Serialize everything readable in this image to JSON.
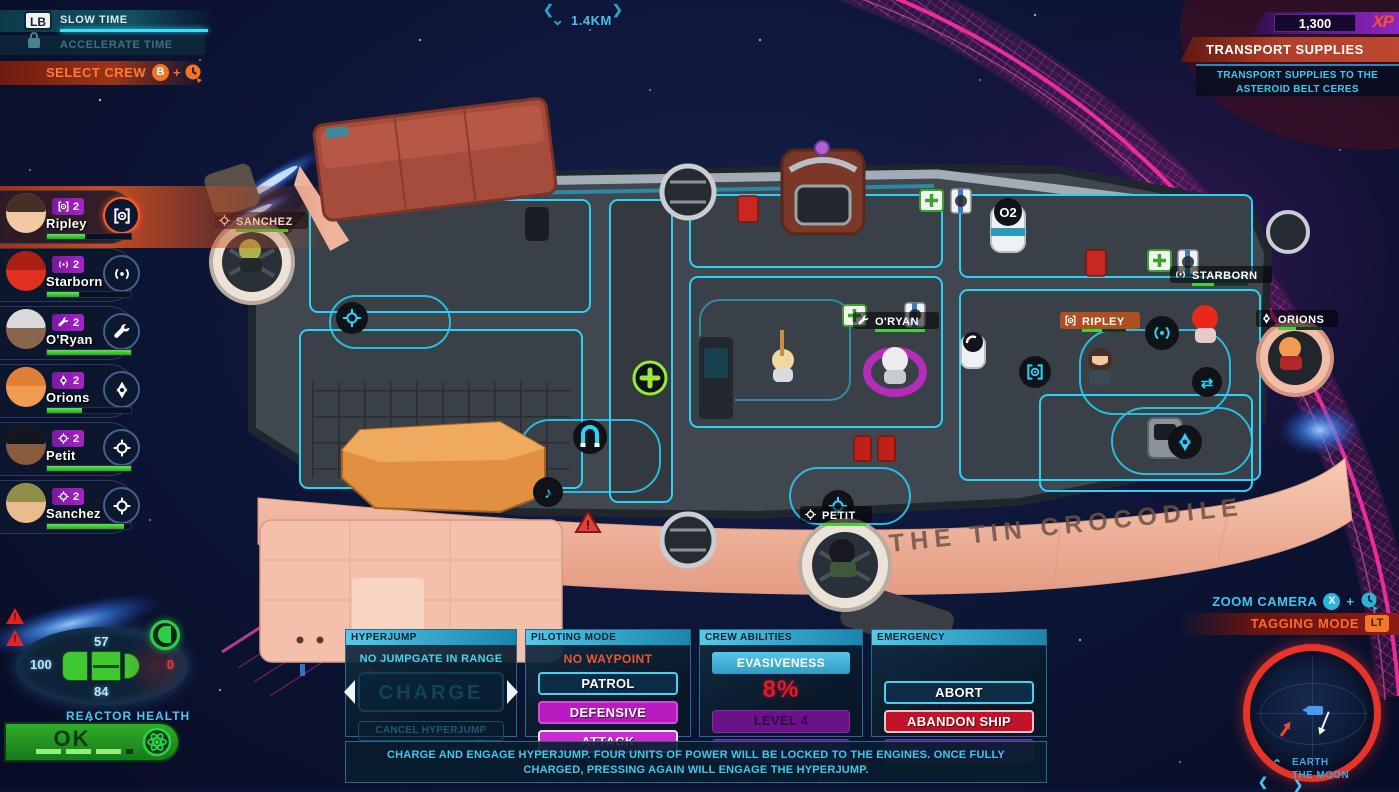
{
  "hud": {
    "top_left": {
      "slow_time_key": "LB",
      "slow_time_label": "SLOW TIME",
      "accelerate_time_label": "ACCELERATE TIME",
      "select_crew_label": "SELECT CREW",
      "select_crew_key": "B",
      "select_crew_plus": "+"
    },
    "top_center": {
      "distance_label": "1.4KM",
      "chevron_left": "❮",
      "chevron_right": "❯",
      "chevron_down": "⌄"
    },
    "top_right": {
      "xp_value": "1,300",
      "xp_label": "XP",
      "mission_title": "TRANSPORT SUPPLIES",
      "mission_objective_line1": "TRANSPORT SUPPLIES TO THE",
      "mission_objective_line2": "ASTEROID BELT CERES"
    },
    "right": {
      "zoom_camera_label": "ZOOM CAMERA",
      "zoom_camera_key": "X",
      "zoom_camera_plus": "+",
      "tagging_mode_label": "TAGGING MODE",
      "tagging_mode_key": "LT"
    },
    "minimap": {
      "location_line1": "EARTH",
      "location_line2": "THE MOON",
      "nav_up": "⌃",
      "nav_left": "❮",
      "nav_right": "❯"
    },
    "warning_mark": "!"
  },
  "crew_panel": {
    "members": [
      {
        "name": "Ripley",
        "level": "2",
        "role": "gunner",
        "health_pct": 45,
        "selected": true,
        "skin": "#f2c9a4",
        "hair": "#463024"
      },
      {
        "name": "Starborn",
        "level": "2",
        "role": "comms",
        "health_pct": 38,
        "selected": false,
        "skin": "#e23020",
        "hair": "#a82014"
      },
      {
        "name": "O'Ryan",
        "level": "2",
        "role": "engineer",
        "health_pct": 100,
        "selected": false,
        "skin": "#8a6550",
        "hair": "#d9d9d9"
      },
      {
        "name": "Orions",
        "level": "2",
        "role": "security",
        "health_pct": 42,
        "selected": false,
        "skin": "#f29a50",
        "hair": "#e08038"
      },
      {
        "name": "Petit",
        "level": "2",
        "role": "weapons",
        "health_pct": 100,
        "selected": false,
        "skin": "#8a5a3c",
        "hair": "#15151d"
      },
      {
        "name": "Sanchez",
        "level": "2",
        "role": "weapons",
        "health_pct": 92,
        "selected": false,
        "skin": "#ebbb90",
        "hair": "#8f8f4a"
      }
    ]
  },
  "ship_status": {
    "shield_top": "57",
    "shield_left": "100",
    "shield_right": "0",
    "shield_bottom": "84"
  },
  "reactor": {
    "label": "REACTOR HEALTH",
    "status": "OK"
  },
  "command_panels": {
    "hyperjump": {
      "header": "HYPERJUMP",
      "status": "NO JUMPGATE IN RANGE",
      "charge_label": "CHARGE",
      "cancel_label": "CANCEL HYPERJUMP"
    },
    "piloting": {
      "header": "PILOTING MODE",
      "status": "NO WAYPOINT",
      "patrol_label": "PATROL",
      "defensive_label": "DEFENSIVE",
      "attack_label": "ATTACK"
    },
    "crew_abilities": {
      "header": "CREW ABILITIES",
      "ability_label": "EVASIVENESS",
      "ability_value": "8%",
      "locked_1": "LEVEL 4",
      "locked_2": "LEVEL 8"
    },
    "emergency": {
      "header": "EMERGENCY",
      "abort_label": "ABORT",
      "abandon_label": "ABANDON SHIP",
      "locked_label": "LEVEL 6"
    },
    "hint": "CHARGE AND ENGAGE HYPERJUMP. FOUR UNITS OF POWER WILL BE LOCKED TO THE ENGINES. ONCE FULLY CHARGED, PRESSING AGAIN WILL ENGAGE THE HYPERJUMP."
  },
  "ship": {
    "name": "THE TIN CROCODILE",
    "o2_label": "O2",
    "crew_tags": [
      {
        "name": "SANCHEZ"
      },
      {
        "name": "O'RYAN"
      },
      {
        "name": "RIPLEY"
      },
      {
        "name": "STARBORN"
      },
      {
        "name": "ORIONS"
      },
      {
        "name": "PETIT"
      }
    ]
  },
  "colors": {
    "accent_cyan": "#35c8e8",
    "accent_orange": "#f0602a",
    "alert_red": "#e01828",
    "magenta": "#c828cc",
    "purple_badge": "#9a1fb4",
    "health_green": "#3fd434",
    "shield_pink": "#ff2da6"
  }
}
